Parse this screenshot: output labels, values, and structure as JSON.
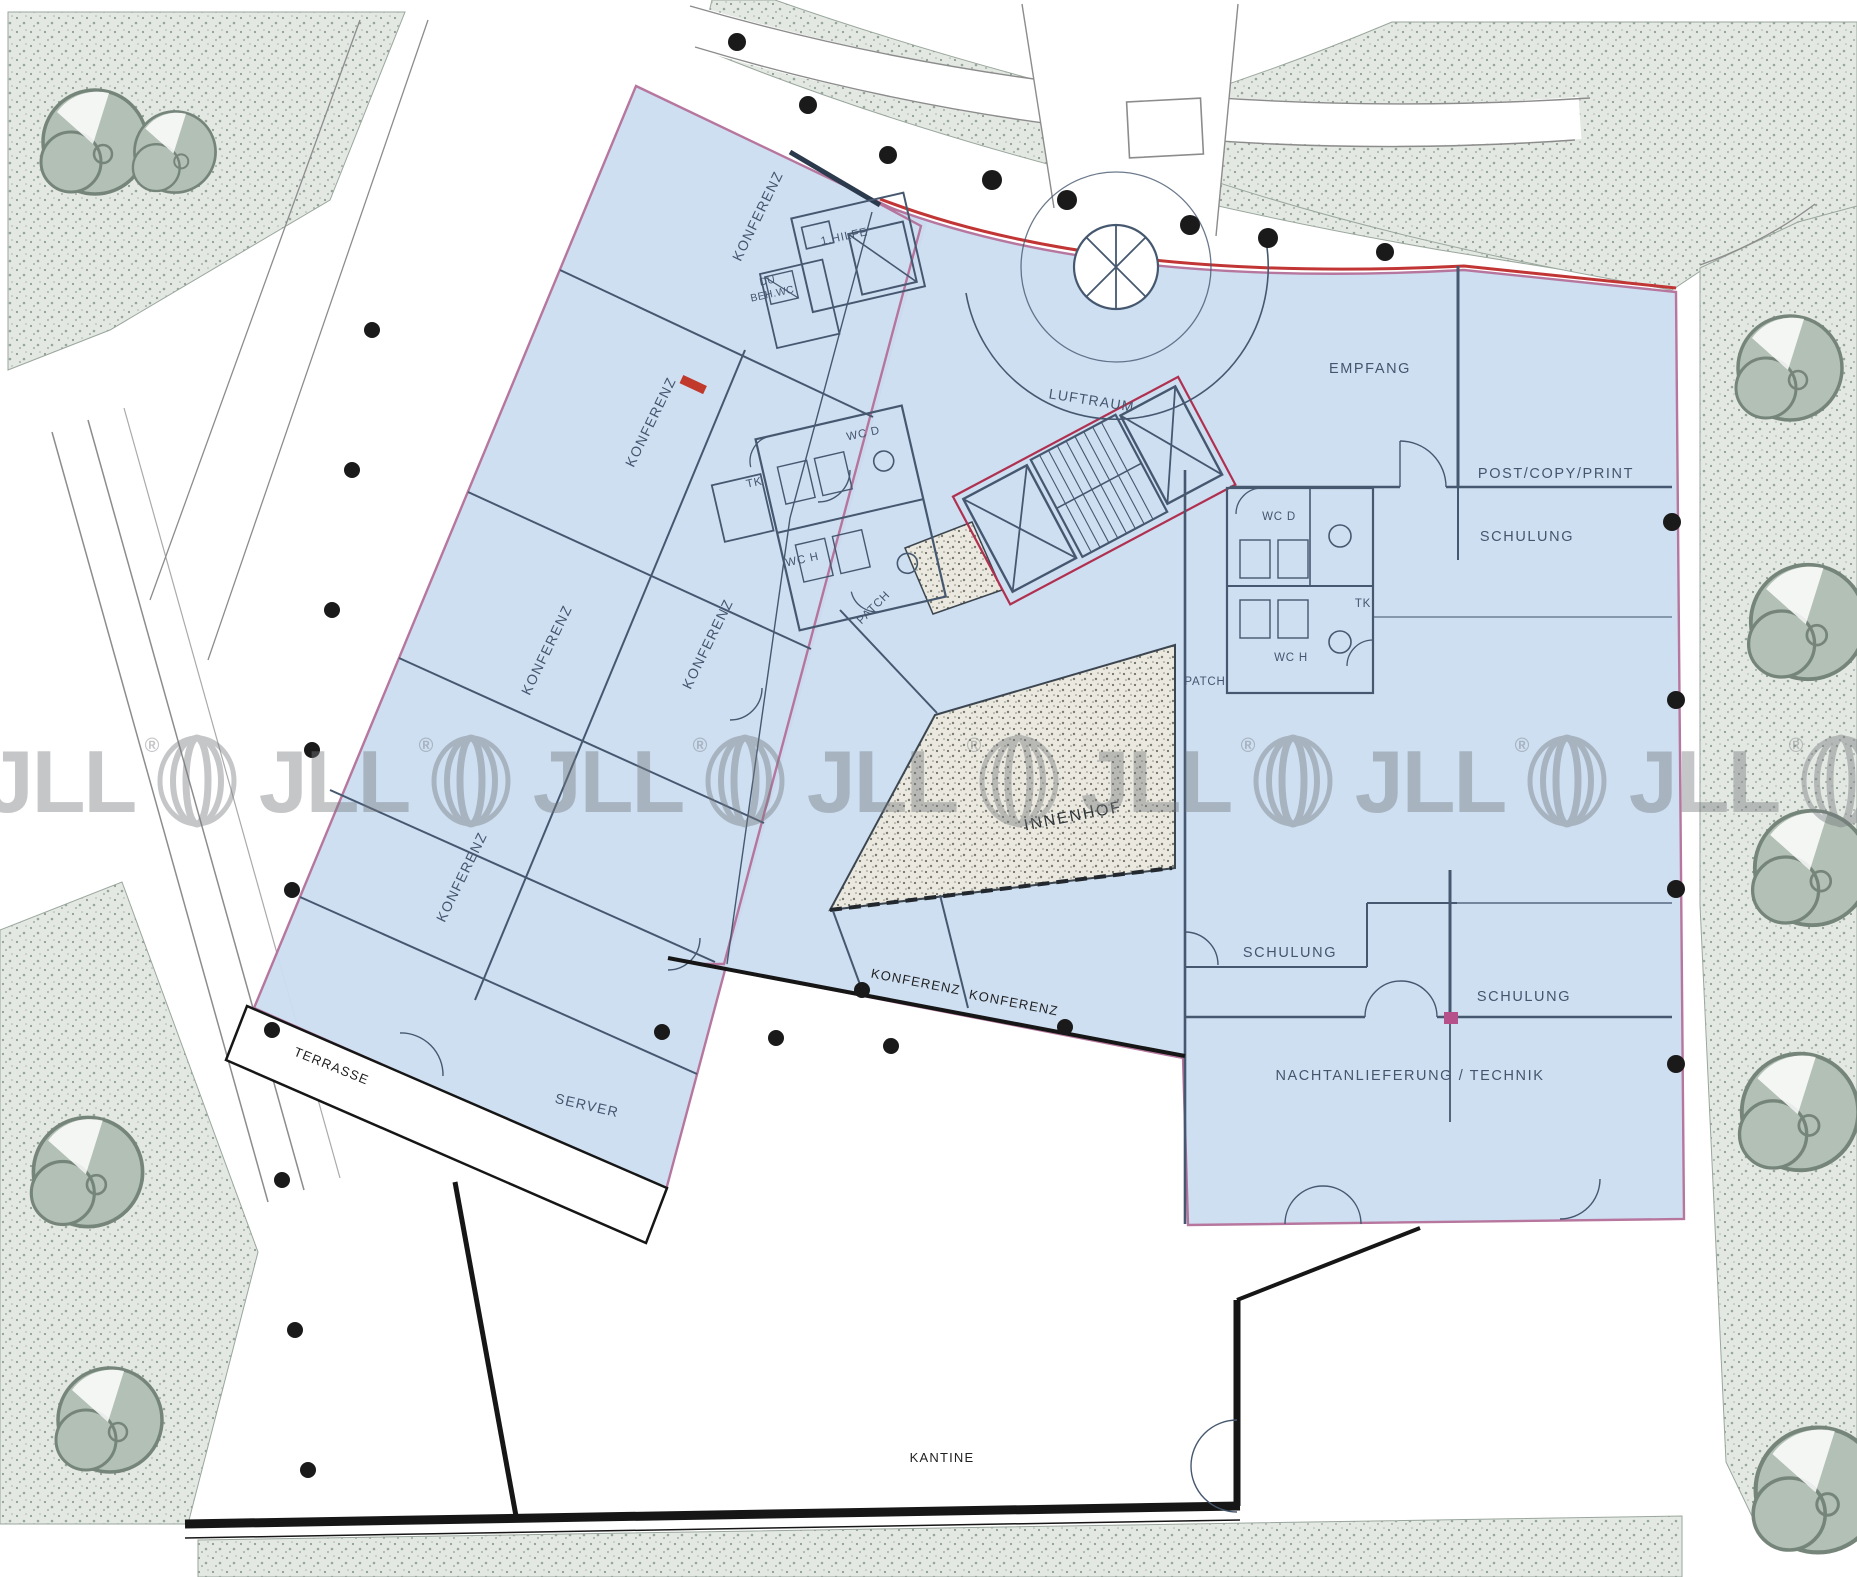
{
  "watermark": {
    "brand": "JLL",
    "reg": "®"
  },
  "rooms": {
    "konferenz_nw": "KONFERENZ",
    "hilfe": "1.HILFE",
    "du": "DU",
    "beh_wc": "BEH.WC",
    "konferenz_w1": "KONFERENZ",
    "konferenz_w2": "KONFERENZ",
    "konferenz_w3": "KONFERENZ",
    "konferenz_w4": "KONFERENZ",
    "wc_d_left": "WC D",
    "tk_left": "TK",
    "wc_h_left": "WC H",
    "patch_left": "PATCH",
    "luftraum": "LUFTRAUM",
    "empfang": "EMPFANG",
    "post_copy_print": "POST/COPY/PRINT",
    "schulung_ne": "SCHULUNG",
    "wc_d_right": "WC D",
    "tk_right": "TK",
    "wc_h_right": "WC H",
    "patch_right": "PATCH",
    "innenhof": "INNENHOF",
    "konferenz_c1": "KONFERENZ",
    "konferenz_c2": "KONFERENZ",
    "schulung_mid": "SCHULUNG",
    "schulung_se": "SCHULUNG",
    "nachtanlieferung": "NACHTANLIEFERUNG  /  TECHNIK",
    "server": "SERVER",
    "terrasse": "TERRASSE",
    "kantine": "KANTINE"
  },
  "colors": {
    "lease_highlight": "#cddef2",
    "wall_slate": "#46586f",
    "wall_black": "#161616",
    "accent_red": "#c13535",
    "accent_pink": "#b5729b",
    "landscape_fill": "#e3e8e3",
    "landscape_dot": "#8e9d92",
    "tree_fill": "#b3c0b6",
    "courtyard_fill": "#eae8df",
    "watermark_gray": "#75797d"
  }
}
